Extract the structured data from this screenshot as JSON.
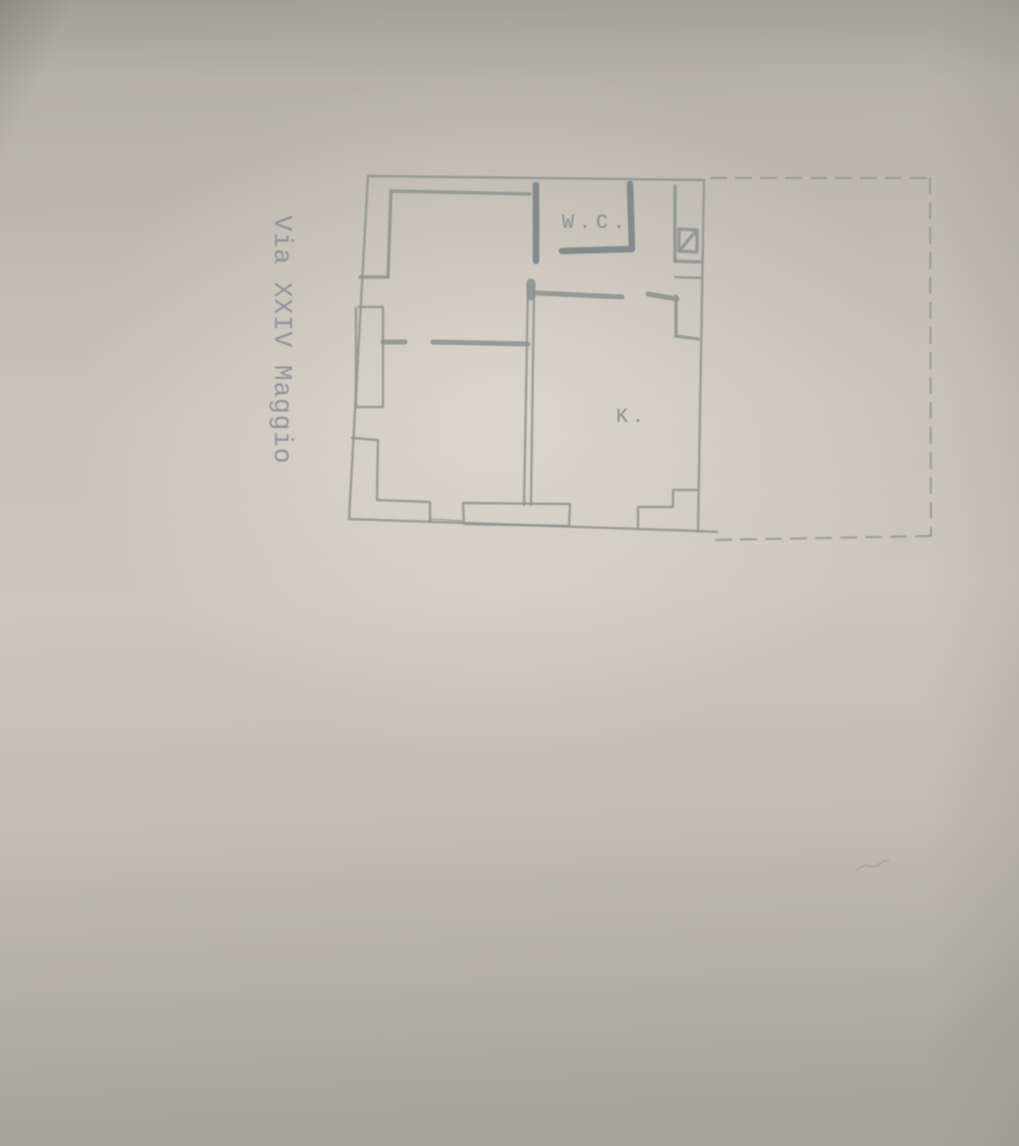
{
  "page": {
    "street_label": "Via XXIV Maggio",
    "labels": {
      "wc": "W.C.",
      "kitchen": "K."
    }
  },
  "colors": {
    "paper_light": "#cbc7bd",
    "paper_dark": "#a7a49c",
    "ink_gray": "#8f948f",
    "ink_dark": "#7f8686",
    "dashed_outline": "#989c96"
  }
}
